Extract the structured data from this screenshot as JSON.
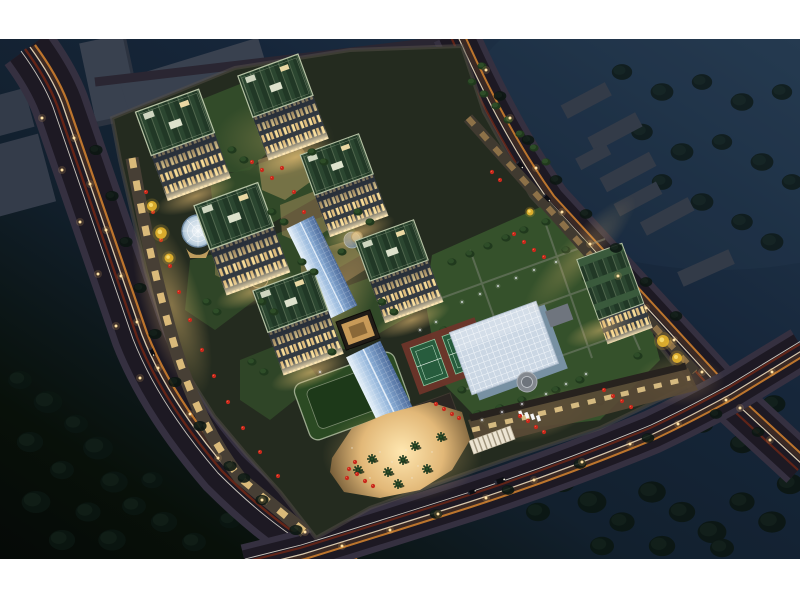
{
  "meta": {
    "scene_type": "aerial-night-architectural-rendering",
    "view": "birds-eye perspective of a lit residential and retail complex at night",
    "letterbox": {
      "top_height": 39,
      "bottom_start": 559
    }
  },
  "palette": {
    "letterbox": "#ffffff",
    "sky_top": "#24394f",
    "sky_mid": "#12202e",
    "ground_dark": "#050907",
    "road": "#1d1923",
    "sidewalk": "#353040",
    "trail_orange": "#d4822f",
    "trail_cream": "#ecdcbc",
    "trail_red": "#7e2a14",
    "trail_white": "#f5f0e4",
    "streetlight": "#ffd98f",
    "podium": "#242b1f",
    "facade_dark": "#333a41",
    "window_warm": "#f6da96",
    "window_warm2": "#dfbd7d",
    "roof_green_a": "#2b4630",
    "roof_green_b": "#213826",
    "parapet": "#b6c2a4",
    "lawn": "#35512b",
    "field_outer": "#2b4a23",
    "field_inner": "#1d3919",
    "tennis_pad": "#6e352a",
    "tennis_court": "#275c3d",
    "canopy_light": "#e8f2fa",
    "canopy_mid": "#8cb0d8",
    "canopy_dark": "#4a6898",
    "glass_roof": "#cbd7e4",
    "glass_grid": "#f3f7fb",
    "dome_light": "#eef4f8",
    "dome_edge": "#9fb8cc",
    "plaza_warm": "#ffe7b0",
    "plaza_mid": "#e2b878",
    "umbrella_red": "#c8291c",
    "palm_green": "#1d3a1e",
    "tree_site": "#2e4d28",
    "tree_dark": "#0c1712",
    "neighbor_block": "#39414f",
    "neighbor_side": "#272d38",
    "yellow_tree": "#e8b62e",
    "atrium_warm": "#c89a58",
    "retail_glow": "#ffd98c"
  },
  "legend": {
    "residential-tower": "lit high-rise with green roof garden",
    "glass-canopy": "blue barrel-vault glass canopy over retail street",
    "natatorium-glass-roof": "large white grid glass roof",
    "tennis-courts": "two green courts on red pad",
    "sports-field": "dark green field on podium",
    "glass-dome": "round glass dome at west entrance",
    "retail-plaza": "warm lit plaza with palms and red umbrellas",
    "roads": "three boulevards with headlight / taillight trails"
  }
}
